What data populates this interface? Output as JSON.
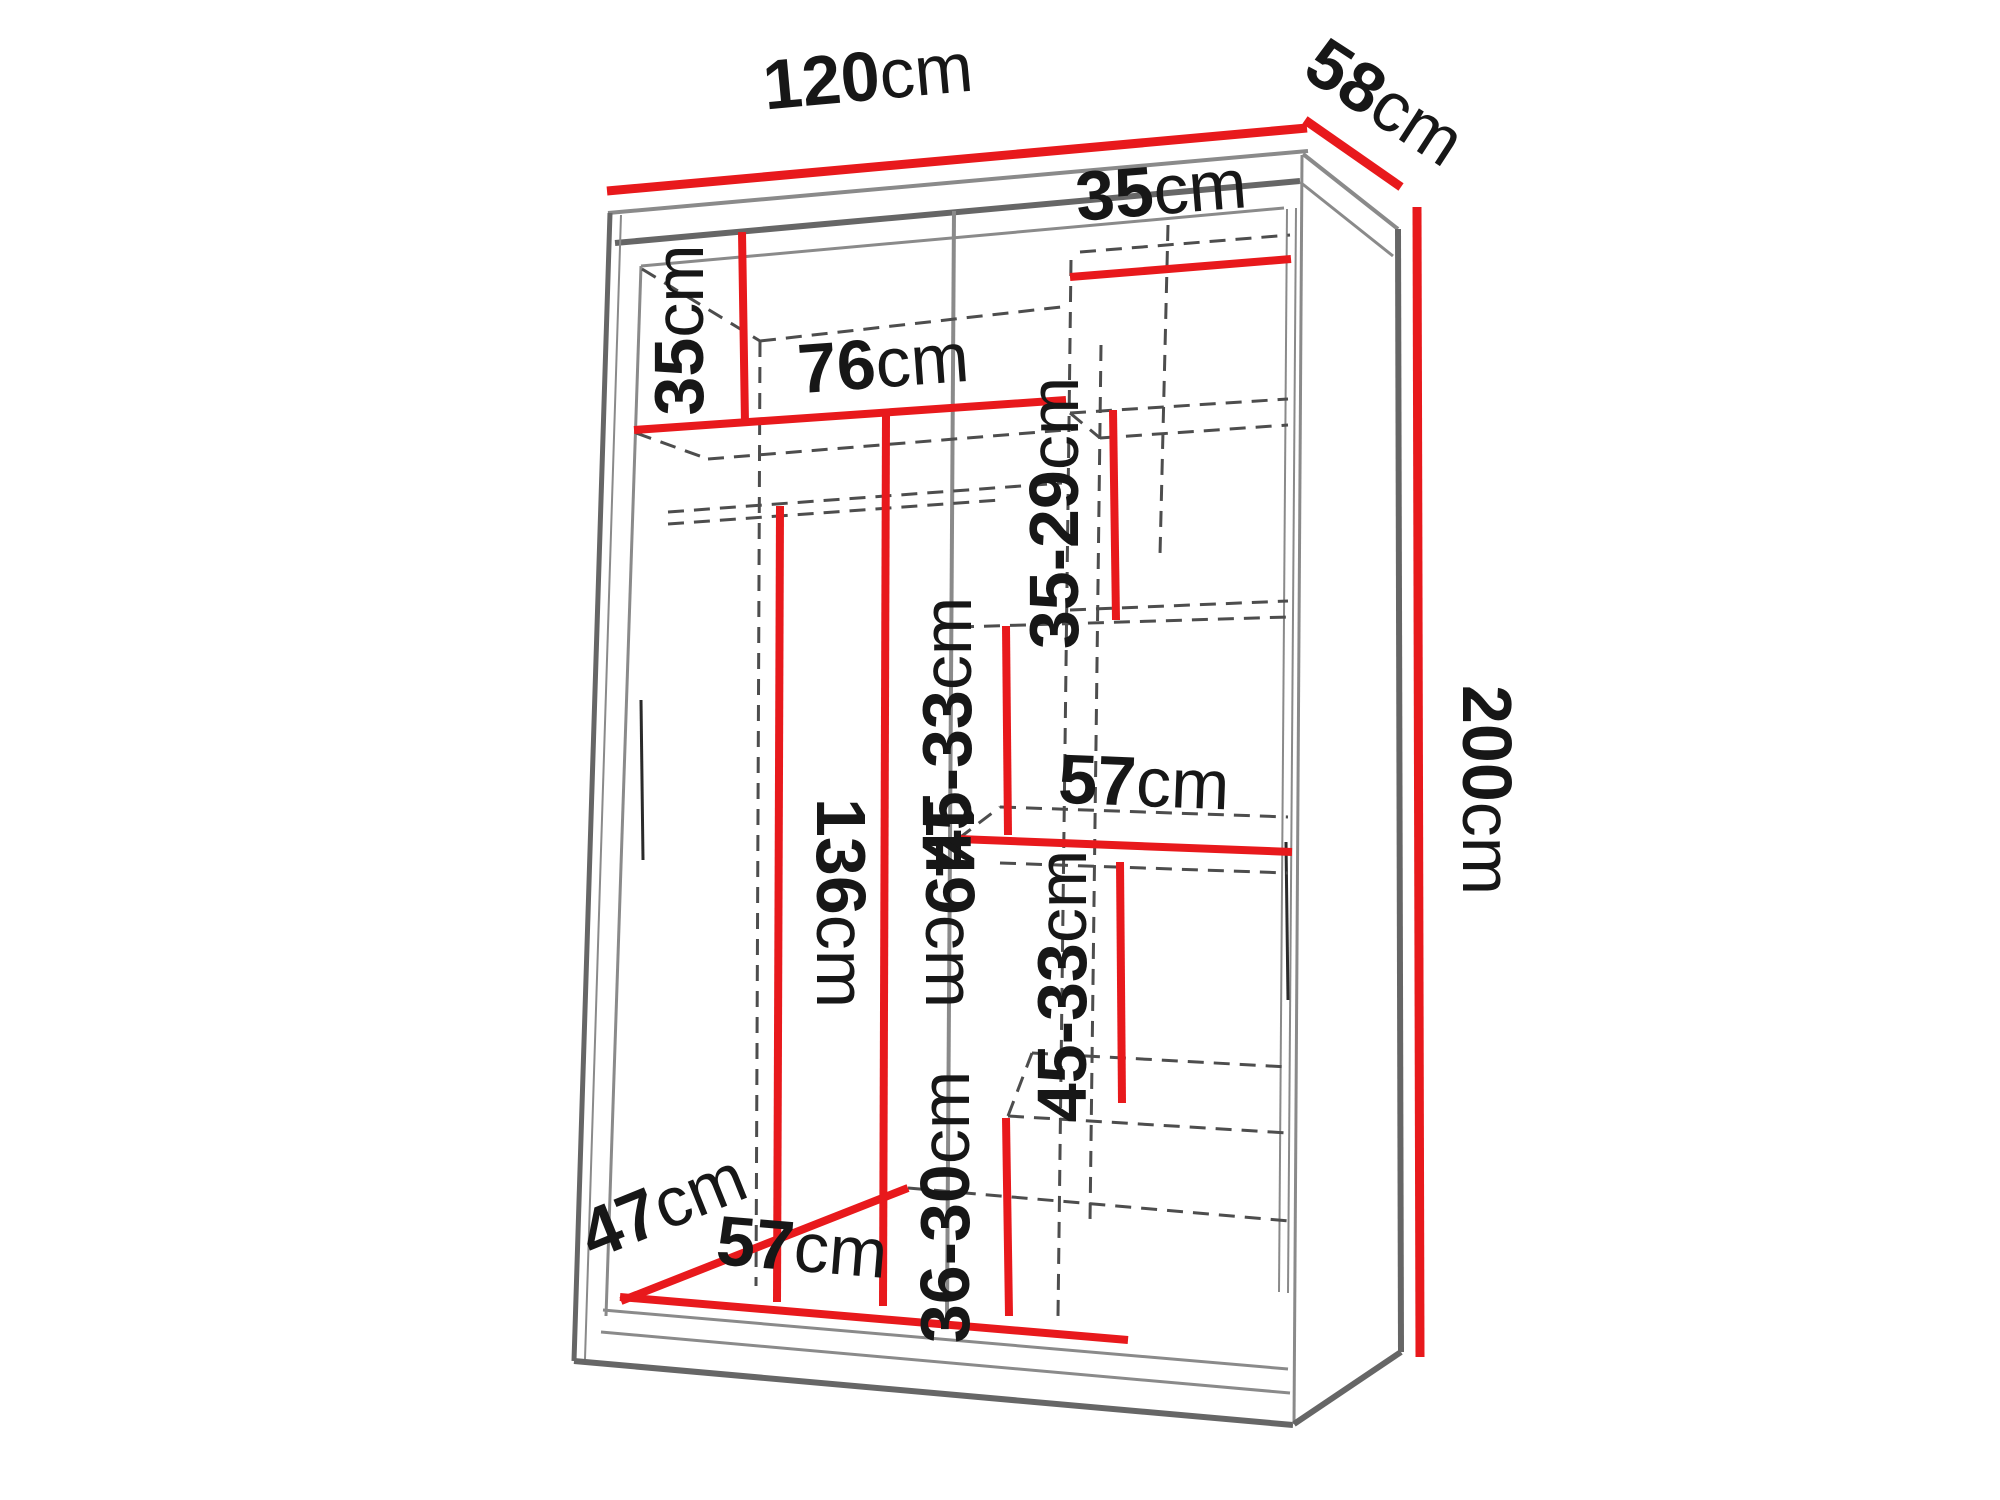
{
  "diagram": {
    "type": "wardrobe-dimension-diagram",
    "colors": {
      "dimension_line": "#e8191c",
      "outline": "#666666",
      "hidden_line": "#4d4d4d",
      "text": "#171717"
    }
  },
  "dimensions": {
    "width": {
      "value": "120",
      "unit": "cm"
    },
    "depth": {
      "value": "58",
      "unit": "cm"
    },
    "height": {
      "value": "200",
      "unit": "cm"
    },
    "top_right_shelf": {
      "value": "35",
      "unit": "cm"
    },
    "top_left_shelf": {
      "value": "35",
      "unit": "cm"
    },
    "left_width": {
      "value": "76",
      "unit": "cm"
    },
    "gap_top_right": {
      "value": "35-29",
      "unit": "cm"
    },
    "gap_upper_right": {
      "value": "45-33",
      "unit": "cm"
    },
    "mid_right_width": {
      "value": "57",
      "unit": "cm"
    },
    "gap_lower_right": {
      "value": "45-33",
      "unit": "cm"
    },
    "hanging_height": {
      "value": "136",
      "unit": "cm"
    },
    "left_height": {
      "value": "149",
      "unit": "cm"
    },
    "gap_bottom_right": {
      "value": "36-30",
      "unit": "cm"
    },
    "floor_depth": {
      "value": "47",
      "unit": "cm"
    },
    "bottom_width": {
      "value": "57",
      "unit": "cm"
    }
  }
}
